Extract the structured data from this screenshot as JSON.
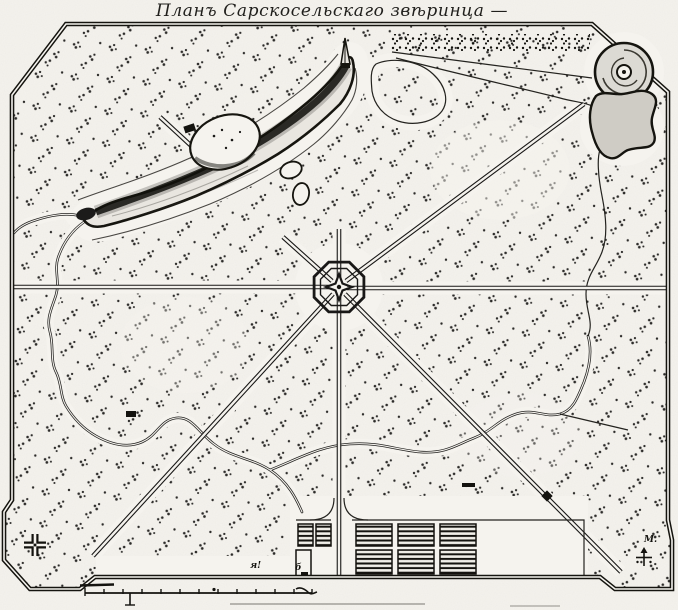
{
  "map": {
    "title": "Планъ Сарскосельскаго звѣринца —",
    "annotations": [
      {
        "text": "я!"
      },
      {
        "text": "б"
      },
      {
        "text": "М."
      }
    ],
    "scale_bar": {
      "tick_count": 13
    },
    "colors": {
      "paper": "#f5f3ee",
      "ink": "#191817",
      "water": "#e9e6e0",
      "shade_gray": "#d9d6cf"
    },
    "icons": [
      {
        "name": "octagon-pavilion-icon"
      },
      {
        "name": "spiral-mound-icon"
      },
      {
        "name": "cross-pavilion-icon"
      },
      {
        "name": "compass-rose-icon"
      },
      {
        "name": "sluice-flag-icon"
      }
    ]
  }
}
